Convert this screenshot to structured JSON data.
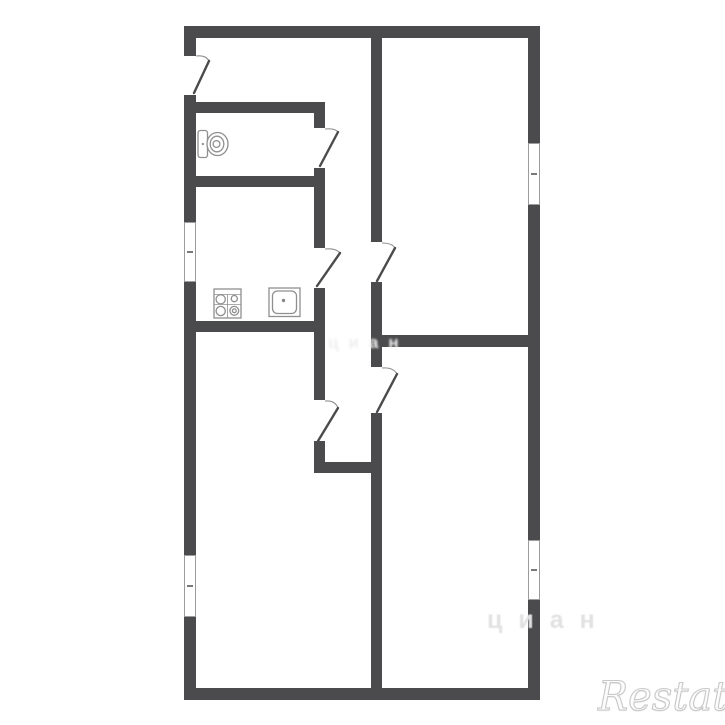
{
  "colors": {
    "wall": "#4b4b4d",
    "fixture": "#8f8f8f",
    "windowframe": "#9c9c9c",
    "doorarc": "#8f8f8f",
    "watermarkfaint": "#e2e2e2",
    "watermarkbrand": "#c8c8c8",
    "background": "#ffffff"
  },
  "watermarks": {
    "brand": "Restate",
    "faint": "циан",
    "faint2": "циан"
  },
  "icons": {
    "toilet": "toilet-icon",
    "stove": "stove-icon",
    "sink": "sink-icon",
    "window": "window-symbol",
    "door": "door-leaf-icon"
  }
}
